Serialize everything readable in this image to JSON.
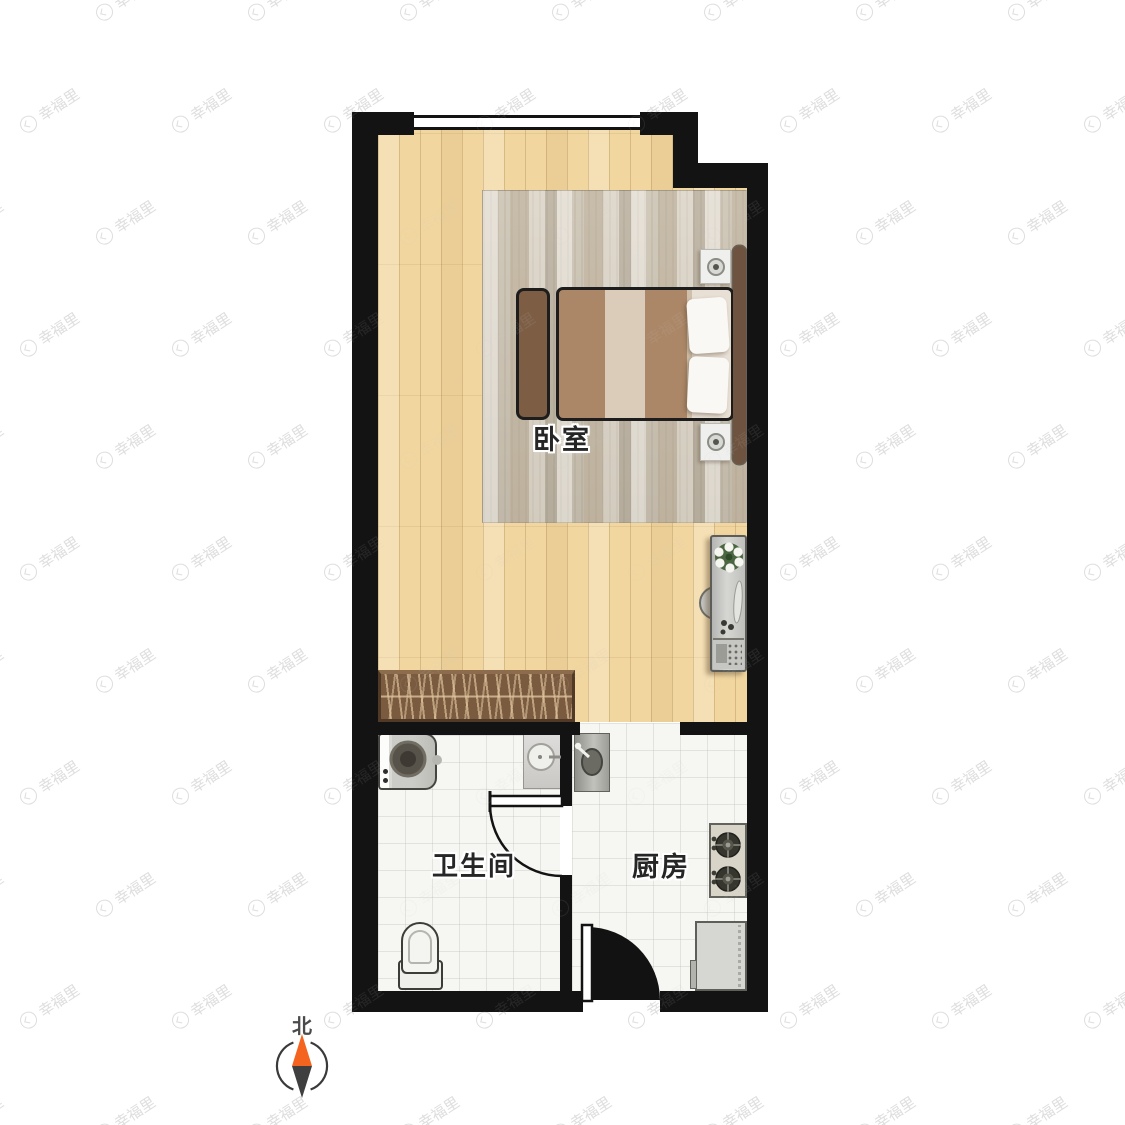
{
  "rooms": {
    "bedroom": {
      "label": "卧室"
    },
    "bathroom": {
      "label": "卫生间"
    },
    "kitchen": {
      "label": "厨房"
    }
  },
  "compass": {
    "north_label": "北",
    "north_color": "#f4641e",
    "south_color": "#3f3f3f"
  },
  "watermark": {
    "text": "幸福里",
    "logo_icon": "xingfuli-house-logo"
  },
  "colors": {
    "wall": "#131313",
    "wood_floor": "#f2d69f",
    "tile_floor": "#f6f6f3",
    "rug": "#cfc7b7",
    "blanket_tan": "#ab8767",
    "blanket_cream": "#dbccba",
    "wood_furniture": "#7a5b40",
    "fixture_gray": "#c9c8c5"
  },
  "furniture_icons": [
    "double-bed",
    "bed-bench",
    "nightstand-lamp",
    "area-rug",
    "vanity-desk",
    "desk-chair",
    "potted-plant",
    "wardrobe-closet",
    "washing-machine",
    "bathroom-sink",
    "toilet",
    "kitchen-sink",
    "gas-stove",
    "refrigerator",
    "door-swing",
    "window"
  ]
}
